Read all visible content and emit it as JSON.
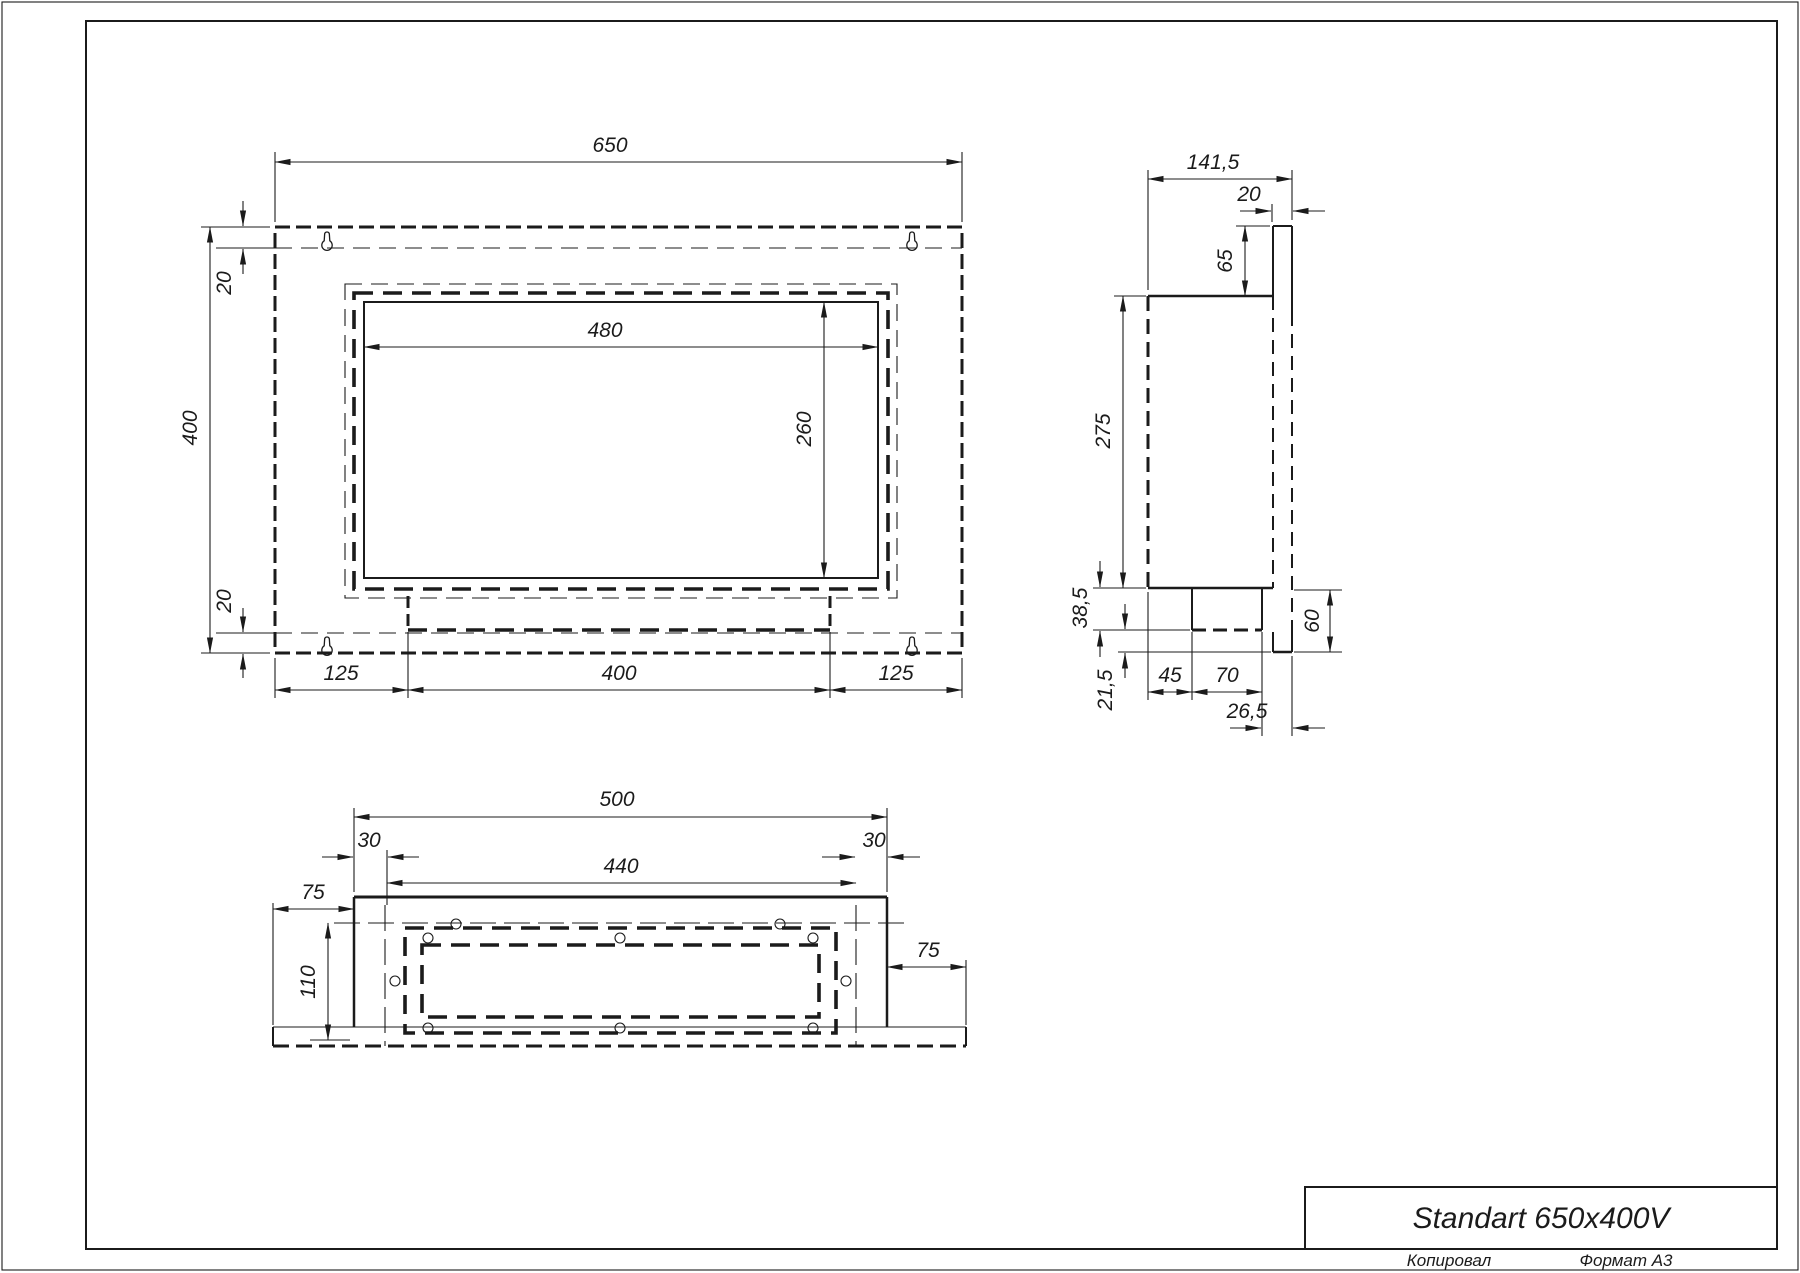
{
  "title_block": {
    "title": "Standart 650x400V",
    "copied_label": "Копировал",
    "format_label": "Формат А3"
  },
  "views": {
    "front": {
      "dims": {
        "overall_width": "650",
        "overall_height": "400",
        "offset_top": "20",
        "offset_bottom": "20",
        "opening_width": "480",
        "opening_height": "260",
        "margin_left": "125",
        "burner_width": "400",
        "margin_right": "125"
      }
    },
    "side": {
      "dims": {
        "overall_depth": "141,5",
        "flange_thickness": "20",
        "top_inset": "65",
        "body_height": "275",
        "tray_depth": "38,5",
        "bottom_inset": "21,5",
        "tray_offset": "45",
        "tray_width": "70",
        "front_offset": "26,5",
        "lower_height": "60"
      }
    },
    "bottom": {
      "dims": {
        "body_width": "500",
        "inset_left": "30",
        "holes_span": "440",
        "inset_right": "30",
        "flange_left": "75",
        "flange_right": "75",
        "body_depth": "110"
      }
    }
  }
}
